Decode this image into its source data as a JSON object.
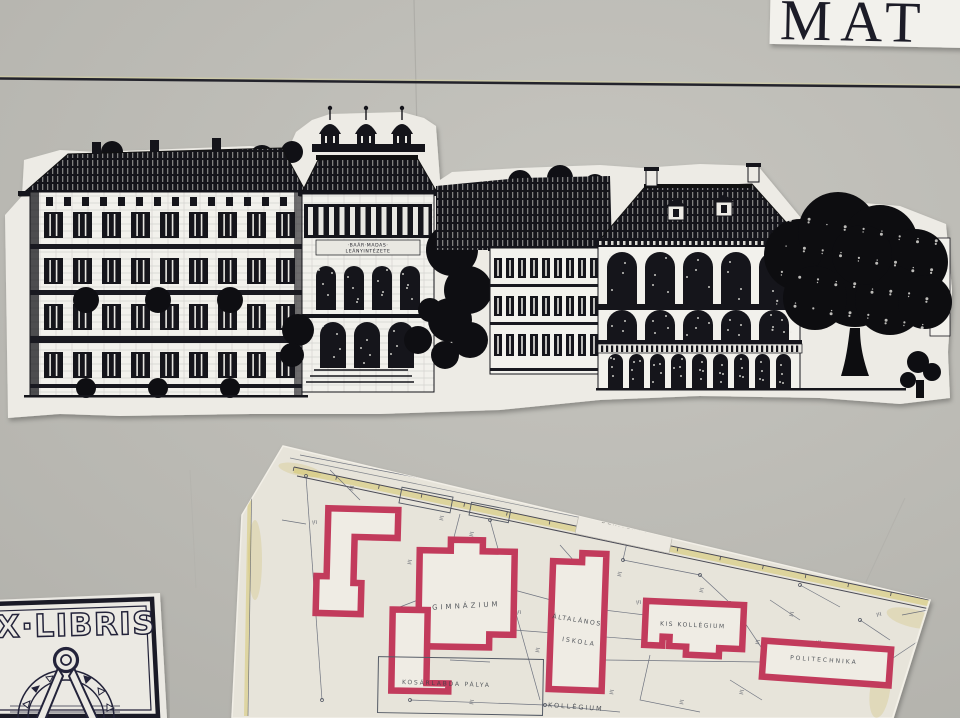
{
  "wall": {
    "color": "#b9b8b2",
    "line_color": "#23232b"
  },
  "mat_sign": {
    "text": "MAT",
    "paper_color": "#f2f1ec",
    "ink_color": "#1c1c27"
  },
  "elevation": {
    "paper_color": "#edebe5",
    "ink_color": "#15151b",
    "inscription_line1": "·BAÁR·MADAS·",
    "inscription_line2": "LEÁNYINTÉZETE"
  },
  "plan": {
    "paper_color": "#e7e4da",
    "red_outline_color": "#c23b5c",
    "road_highlight_color": "#d5c66a",
    "labels": {
      "gimnazium": "GIMNÁZIUM",
      "altalanos": "ÁLTALÁNOS",
      "iskola": "ISKOLA",
      "kosarlabda_palya": "KOSÁRLABDA PÁLYA",
      "kis_kollegium": "KIS KOLLÉGIUM",
      "kollegium": "KOLLÉGIUM",
      "politechnika": "POLITECHNIKA",
      "slip_note": "DERÍTENDŐ"
    }
  },
  "exlibris": {
    "title": "EX·LIBRIS",
    "ink_color": "#23233a",
    "paper_color": "#ebe9e3"
  }
}
